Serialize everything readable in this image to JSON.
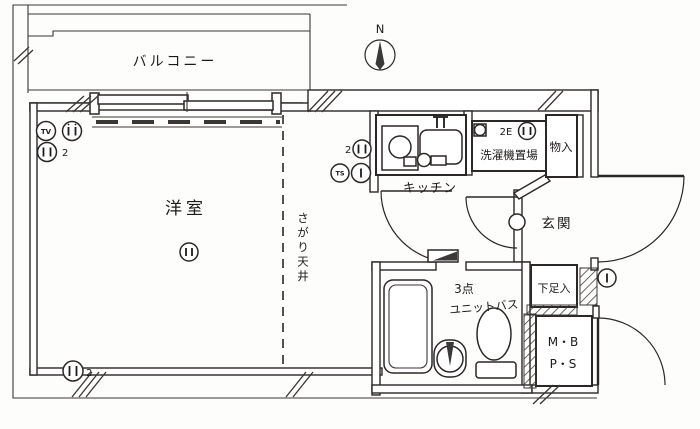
{
  "rooms": {
    "balcony": "バルコニー",
    "living": "洋室",
    "lowered_ceiling": "さがり天井",
    "kitchen": "キッチン",
    "laundry": "洗濯機置場",
    "storage": "物入",
    "entrance": "玄関",
    "shoe_cabinet": "下足入",
    "unit_bath_line1": "3点",
    "unit_bath_line2": "ユニットバス",
    "meter_box": "M・B",
    "pipe_space": "P・S"
  },
  "symbols": {
    "compass_north": "N",
    "tv_outlet": "TV",
    "ts_outlet": "TS",
    "outlet_count_top_left": "2",
    "outlet_count_bottom_left": "2",
    "outlet_count_kitchen": "2",
    "laundry_outlet": "2E"
  },
  "colors": {
    "line": "#2b2726",
    "paper": "#fdfdfc",
    "dark_fill": "#3a3a3a"
  }
}
